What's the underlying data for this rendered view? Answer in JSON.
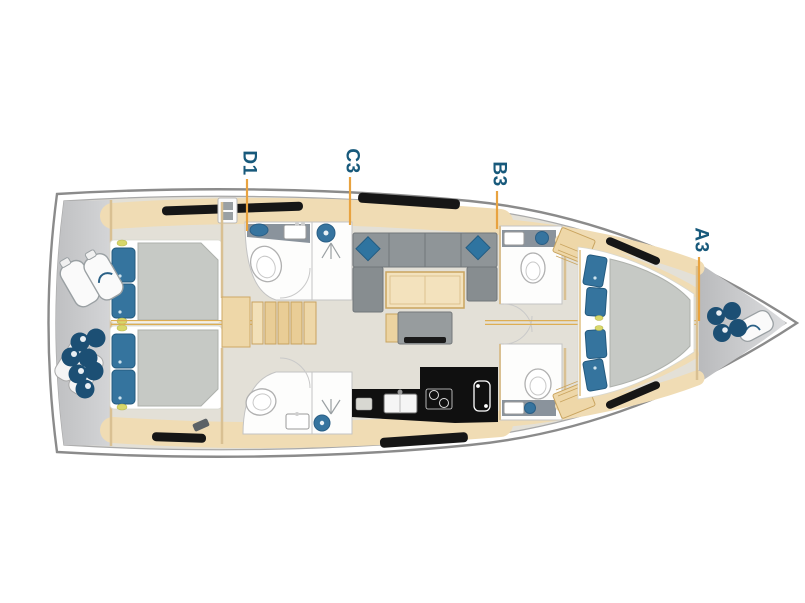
{
  "plan": {
    "type": "yacht-interior-deck-plan",
    "orientation": "bow-right",
    "labels": [
      {
        "id": "D1",
        "x": 249,
        "y": 163,
        "leader": {
          "x": 247,
          "y1": 179,
          "y2": 231
        }
      },
      {
        "id": "C3",
        "x": 352,
        "y": 161,
        "leader": {
          "x": 350,
          "y1": 177,
          "y2": 225
        }
      },
      {
        "id": "B3",
        "x": 499,
        "y": 174,
        "leader": {
          "x": 497,
          "y1": 191,
          "y2": 229
        }
      },
      {
        "id": "A3",
        "x": 701,
        "y": 240,
        "leader": {
          "x": 699,
          "y1": 257,
          "y2": 321
        }
      }
    ],
    "colors": {
      "label": "#17597b",
      "leader": "#e8a340",
      "centerline": "#ddae54",
      "hull_outline": "#8b8b8b",
      "hull_inner": "#a9a9a9",
      "deck_gray": "#c7c8ca",
      "floor": "#e3e0d7",
      "wood": "#f0dcb4",
      "wood_dark": "#c9a45f",
      "wall": "#d9c092",
      "duvet": "#c6c9c5",
      "pillow": "#35749e",
      "sofa": "#8f9598",
      "galley": "#101010",
      "fixture": "#fdfdfc",
      "sink_blue": "#36749f",
      "fender": "#1c4f74",
      "window": "#161616"
    },
    "features": [
      "hull",
      "stern-swim-platform",
      "foredeck",
      "aft-cabin-port",
      "aft-cabin-starboard",
      "companionway-stairs",
      "head-aft-port",
      "head-aft-starboard",
      "head-fwd-port",
      "head-fwd-starboard",
      "saloon-sofa",
      "saloon-table",
      "tv-bench",
      "galley",
      "forward-owner-cabin",
      "fenders-stern",
      "fenders-bow",
      "hull-windows"
    ]
  }
}
